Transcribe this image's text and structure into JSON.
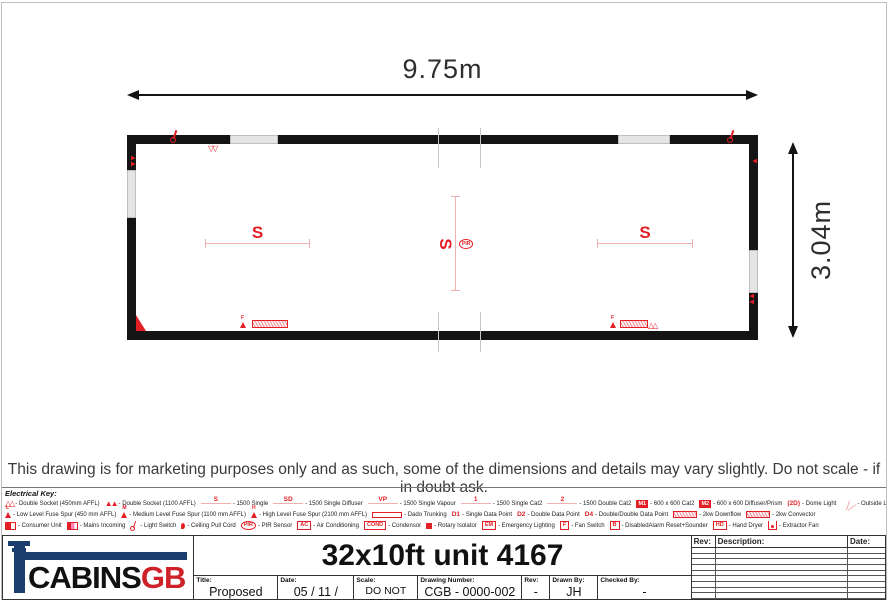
{
  "colors": {
    "accent_red": "#e31e24",
    "wall_black": "#141414",
    "logo_navy": "#1c3e6e",
    "logo_red": "#cf2128"
  },
  "plan": {
    "width_label": "9.75m",
    "height_label": "3.04m",
    "fixtures": {
      "left": "S",
      "center": "S",
      "right": "S",
      "pir": "PIR"
    }
  },
  "disclaimer": "This drawing is for marketing purposes only and as such, some of the dimensions and details may vary slightly. Do not scale - if in doubt ask.",
  "electrical_key": {
    "title": "Electrical Key:",
    "rows": [
      [
        {
          "symbol": "",
          "label": "- Double Socket (450mm AFFL)"
        },
        {
          "symbol": "",
          "label": "- Double Socket (1100 AFFL)"
        },
        {
          "symbol": "S",
          "label": "- 1500 Single"
        },
        {
          "symbol": "SD",
          "label": "- 1500 Single Diffuser"
        },
        {
          "symbol": "VP",
          "label": "- 1500 Single Vapour"
        },
        {
          "symbol": "1",
          "label": "- 1500 Single Cat2"
        },
        {
          "symbol": "2",
          "label": "- 1500 Double Cat2"
        },
        {
          "symbol": "M1",
          "label": "- 600 x 600 Cat2"
        },
        {
          "symbol": "M2",
          "label": "- 600 x 600 Diffuser/Prism"
        },
        {
          "symbol": "2D",
          "label": "- Dome Light"
        },
        {
          "symbol": "",
          "label": "- Outside Light"
        }
      ],
      [
        {
          "symbol": "L",
          "label": "- Low Level Fuse Spur (450 mm AFFL)"
        },
        {
          "symbol": "M",
          "label": "- Medium Level Fuse Spur (1100 mm AFFL)"
        },
        {
          "symbol": "H",
          "label": "- High Level Fuse Spur (2100 mm AFFL)"
        },
        {
          "symbol": "",
          "label": "- Dado Trunking"
        },
        {
          "symbol": "D1",
          "label": "- Single Data Point"
        },
        {
          "symbol": "D2",
          "label": "- Double Data Point"
        },
        {
          "symbol": "D4",
          "label": "- Double/Double Data Point"
        },
        {
          "symbol": "",
          "label": "- 2kw Downflow"
        },
        {
          "symbol": "",
          "label": "- 2kw Convector"
        }
      ],
      [
        {
          "symbol": "",
          "label": "- Consumer Unit"
        },
        {
          "symbol": "",
          "label": "- Mains Incoming"
        },
        {
          "symbol": "",
          "label": "- Light Switch"
        },
        {
          "symbol": "",
          "label": "- Ceiling Pull Cord"
        },
        {
          "symbol": "PIR",
          "label": "- PIR Sensor"
        },
        {
          "symbol": "AC",
          "label": "- Air Conditioning"
        },
        {
          "symbol": "COND",
          "label": "- Condensor"
        },
        {
          "symbol": "",
          "label": "- Rotary Isolator"
        },
        {
          "symbol": "EM",
          "label": "- Emergency Lighting"
        },
        {
          "symbol": "F",
          "label": "- Fan Switch"
        },
        {
          "symbol": "B",
          "label": "- DisabledAlarm Reset+Sounder"
        },
        {
          "symbol": "HD",
          "label": "- Hand Dryer"
        },
        {
          "symbol": "",
          "label": "- Extractor Fan"
        }
      ]
    ]
  },
  "title_block": {
    "logo_cabins": "CABINS",
    "logo_gb": "GB",
    "drawing_title": "32x10ft unit 4167",
    "fields": [
      {
        "label": "Title:",
        "value": "Proposed Layout"
      },
      {
        "label": "Date:",
        "value": "05 / 11 / 2025"
      },
      {
        "label": "Scale:",
        "value": "DO NOT SCALE"
      },
      {
        "label": "Drawing Number:",
        "value": "CGB - 0000-002"
      },
      {
        "label": "Rev:",
        "value": "-"
      },
      {
        "label": "Drawn By:",
        "value": "JH"
      },
      {
        "label": "Checked By:",
        "value": "-"
      }
    ],
    "revision": {
      "rev": "Rev:",
      "description": "Description:",
      "date": "Date:"
    }
  }
}
